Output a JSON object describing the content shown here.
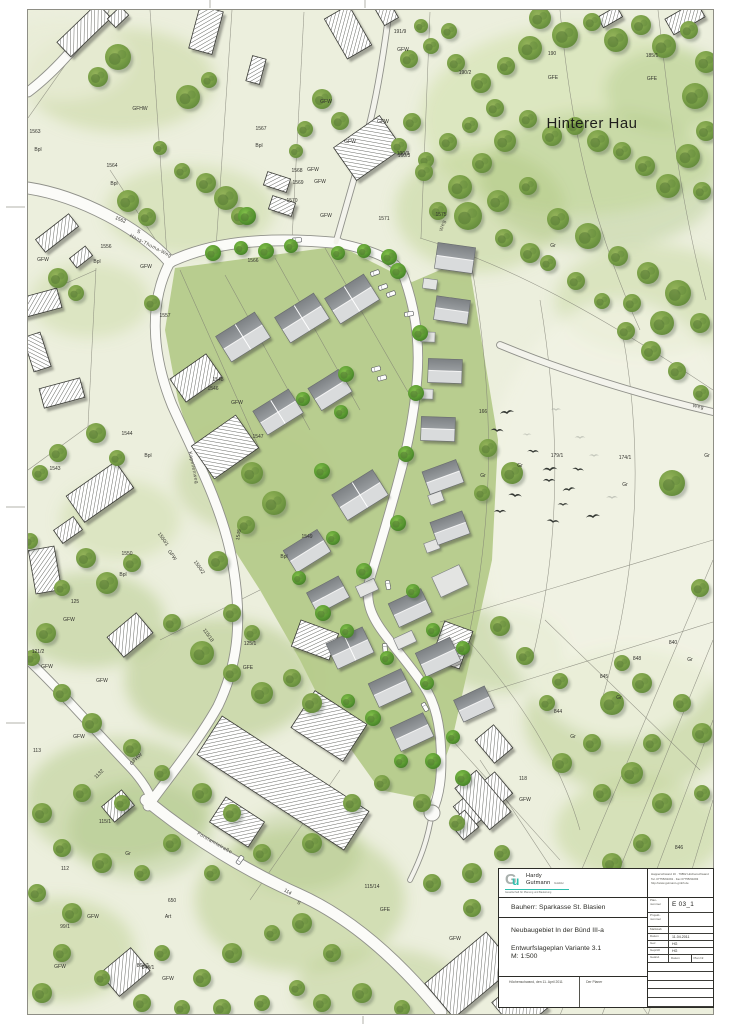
{
  "map": {
    "area_label": "Hinterer Hau",
    "streets": [
      {
        "t": "Hans-Thoma-Weg",
        "x": 150,
        "y": 247,
        "r": 27
      },
      {
        "t": "Kapellenweg",
        "x": 192,
        "y": 468,
        "r": 78
      },
      {
        "t": "Forstamtstraße",
        "x": 214,
        "y": 844,
        "r": 30
      },
      {
        "t": "Weg",
        "x": 444,
        "y": 226,
        "r": -72
      },
      {
        "t": "Weg",
        "x": 698,
        "y": 408,
        "r": 10
      }
    ],
    "parcels": [
      [
        "1563",
        35,
        133
      ],
      [
        "Bpl",
        38,
        151
      ],
      [
        "GFHW",
        140,
        110
      ],
      [
        "1564",
        112,
        167
      ],
      [
        "Bpl",
        114,
        185
      ],
      [
        "1562",
        120,
        221,
        22
      ],
      [
        "S",
        138,
        233,
        22
      ],
      [
        "1556",
        106,
        248
      ],
      [
        "Bpl",
        97,
        263
      ],
      [
        "GFW",
        43,
        261
      ],
      [
        "GFW",
        146,
        268
      ],
      [
        "191/9",
        400,
        33
      ],
      [
        "GFW",
        403,
        51
      ],
      [
        "190/2",
        465,
        74
      ],
      [
        "190",
        552,
        55
      ],
      [
        "GFE",
        553,
        79
      ],
      [
        "185/1",
        652,
        57
      ],
      [
        "GFE",
        652,
        80
      ],
      [
        "190/3",
        403,
        155
      ],
      [
        "1571",
        384,
        220
      ],
      [
        "1575",
        441,
        216
      ],
      [
        "Gr",
        553,
        247
      ],
      [
        "1567",
        261,
        130
      ],
      [
        "Bpl",
        259,
        147
      ],
      [
        "GFW",
        326,
        103
      ],
      [
        "GFW",
        383,
        123
      ],
      [
        "GFW",
        350,
        143
      ],
      [
        "160/3",
        404,
        157
      ],
      [
        "1568",
        297,
        172
      ],
      [
        "GFW",
        313,
        171
      ],
      [
        "1569",
        298,
        184
      ],
      [
        "GFW",
        320,
        183
      ],
      [
        "1570",
        292,
        202
      ],
      [
        "GFW",
        326,
        217
      ],
      [
        "1557",
        165,
        317
      ],
      [
        "1566",
        253,
        262
      ],
      [
        "1548",
        218,
        381
      ],
      [
        "1546",
        213,
        390
      ],
      [
        "GFW",
        237,
        404
      ],
      [
        "1547",
        258,
        438
      ],
      [
        "1549",
        307,
        538
      ],
      [
        "Bpl",
        284,
        558
      ],
      [
        "1544",
        127,
        435
      ],
      [
        "Bpl",
        148,
        457
      ],
      [
        "1543",
        55,
        470
      ],
      [
        "1550",
        127,
        555
      ],
      [
        "1550/1",
        162,
        540,
        55
      ],
      [
        "GFW",
        171,
        556,
        55
      ],
      [
        "1545",
        240,
        535,
        -80
      ],
      [
        "166",
        483,
        413
      ],
      [
        "179/1",
        557,
        457
      ],
      [
        "174/1",
        625,
        459
      ],
      [
        "Gr",
        707,
        457
      ],
      [
        "Gr",
        625,
        486
      ],
      [
        "Gr",
        520,
        467
      ],
      [
        "Gr",
        483,
        477
      ],
      [
        "125",
        75,
        603
      ],
      [
        "GFW",
        69,
        621
      ],
      [
        "Bpl",
        123,
        576
      ],
      [
        "1550/2",
        198,
        568,
        55
      ],
      [
        "115/18",
        207,
        636,
        55
      ],
      [
        "125/1",
        250,
        645
      ],
      [
        "GFE",
        248,
        669
      ],
      [
        "121/2",
        38,
        653
      ],
      [
        "GFW",
        47,
        668
      ],
      [
        "GFW",
        102,
        682
      ],
      [
        "113",
        37,
        752
      ],
      [
        "GFW",
        79,
        738
      ],
      [
        "GFHW",
        137,
        760,
        -45
      ],
      [
        "1132",
        100,
        775,
        -45
      ],
      [
        "115/1",
        105,
        823
      ],
      [
        "Gr",
        128,
        855
      ],
      [
        "112",
        65,
        870
      ],
      [
        "650",
        172,
        902
      ],
      [
        "Art",
        168,
        918
      ],
      [
        "GFW",
        93,
        918
      ],
      [
        "99/1",
        65,
        928
      ],
      [
        "GFW",
        60,
        968
      ],
      [
        "844/1",
        148,
        969
      ],
      [
        "GFW",
        168,
        980
      ],
      [
        "114",
        287,
        893,
        31
      ],
      [
        "S",
        298,
        904,
        31
      ],
      [
        "840",
        673,
        644
      ],
      [
        "Gr",
        690,
        661
      ],
      [
        "848",
        637,
        660
      ],
      [
        "845",
        604,
        678
      ],
      [
        "Gr",
        619,
        699
      ],
      [
        "844",
        558,
        713
      ],
      [
        "Gr",
        573,
        738
      ],
      [
        "118",
        523,
        780
      ],
      [
        "GFW",
        525,
        801
      ],
      [
        "846",
        679,
        849
      ],
      [
        "115/14",
        372,
        888
      ],
      [
        "GFE",
        385,
        911
      ],
      [
        "GFW",
        455,
        940
      ],
      [
        "864/1",
        143,
        967
      ]
    ]
  },
  "title_block": {
    "company": {
      "monogram_g": "G",
      "monogram_u": "u",
      "name_line1": "Hardy",
      "name_line2": "Gutmann",
      "suffix": "GmbH",
      "tagline": "Gesellschaft für Planung und Bauleitung"
    },
    "address_lines": [
      "Happerschwand 16 · 79862 Höchenschwand",
      "Tel. 07755/91091 · Fax 07755/91093",
      "http://www.gutmann-gmbh.de"
    ],
    "client": "Bauherr: Sparkasse St. Blasien",
    "project_line1": "Neubaugebiet In der Bünd III-a",
    "project_line2": "Entwurfslageplan Variante 3.1",
    "scale": "M: 1:500",
    "table": {
      "rows": [
        {
          "l": "Plan-nummer",
          "v": "E 03_1",
          "h": 15,
          "big": true
        },
        {
          "l": "Projekt-nummer",
          "v": "",
          "h": 14
        },
        {
          "l": "Maßstab",
          "v": "",
          "h": 7
        },
        {
          "l": "Datum",
          "v": "11.04.2011",
          "h": 7
        },
        {
          "l": "Gez.",
          "v": "HG",
          "h": 7
        },
        {
          "l": "Geprüft",
          "v": "HG",
          "h": 7
        }
      ],
      "rev_headers": [
        "Geänd.",
        "Datum",
        "Plan Nr."
      ]
    },
    "signature": {
      "place_date": "Höchenschwand, den 11. April 2011",
      "planner": "Der Planer"
    }
  }
}
